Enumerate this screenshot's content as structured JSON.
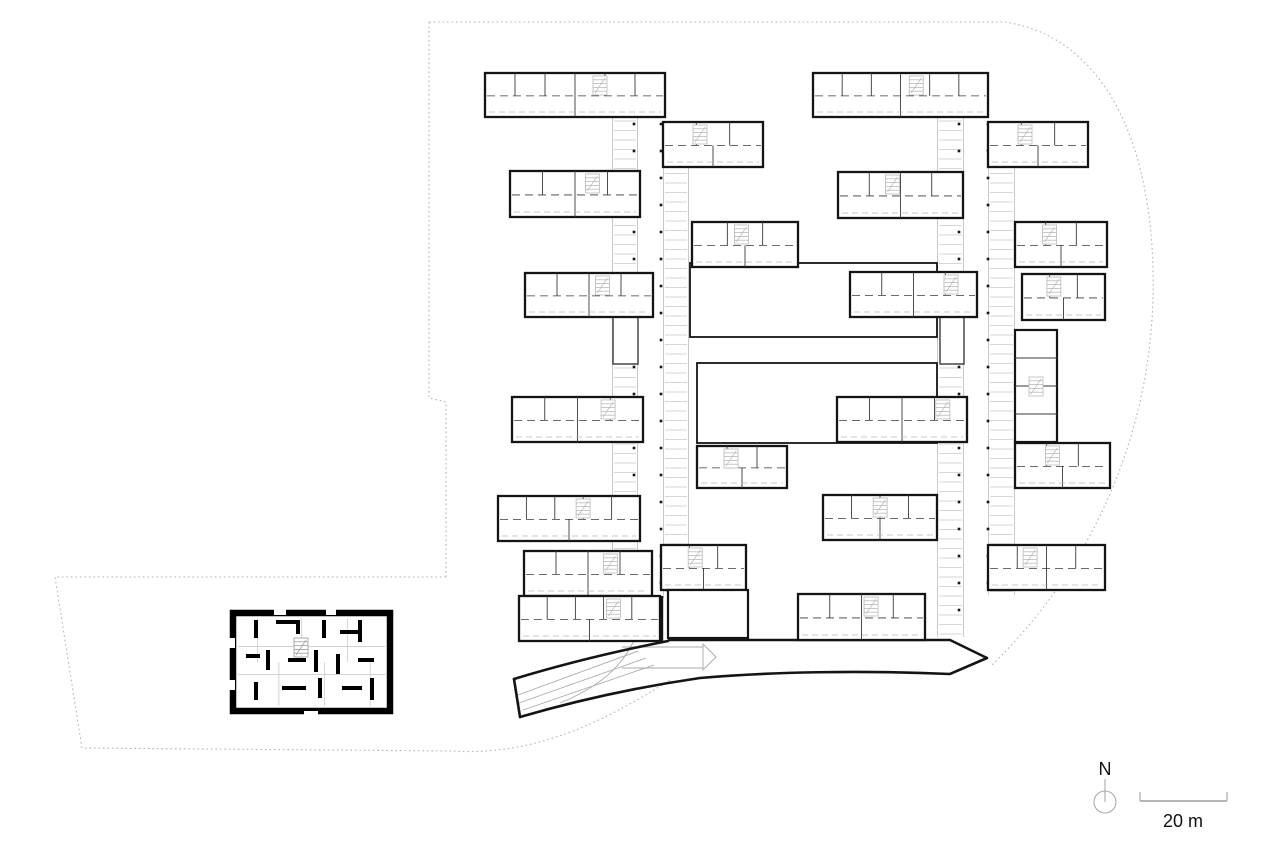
{
  "page": {
    "background": "#ffffff",
    "kind": "architectural floor plan"
  },
  "labels": {
    "north": "N",
    "scale": "20 m"
  },
  "colors": {
    "ink": "#141414",
    "partition": "#3a3a3a",
    "thin": "#a9a9a9",
    "gallery": "#c9c9c9",
    "stair": "#b9b9b9",
    "boundary": "#b3b3b3",
    "scalebar": "#b5b5b5",
    "text": "#111111",
    "paper": "#ffffff"
  },
  "plan": {
    "canvas": {
      "w": 1280,
      "h": 853
    },
    "boundary_paths": [
      "M429,22 H1004 C1092,34 1149,122 1153,268 C1157,418 1100,560 991,666",
      "M429,22 V398 L446,402 V577",
      "M446,577 H55 L82,748 L452,751 C545,757 618,712 672,679"
    ],
    "galleries": [
      {
        "x": 612,
        "y": 117,
        "w": 26,
        "h": 481
      },
      {
        "x": 663,
        "y": 122,
        "w": 26,
        "h": 476
      },
      {
        "x": 937,
        "y": 117,
        "w": 27,
        "h": 520
      },
      {
        "x": 988,
        "y": 122,
        "w": 27,
        "h": 473
      }
    ],
    "dot_columns": [
      {
        "x": 634,
        "y1": 124,
        "y2": 638,
        "step": 27
      },
      {
        "x": 661,
        "y1": 124,
        "y2": 596,
        "step": 27
      },
      {
        "x": 959,
        "y1": 124,
        "y2": 634,
        "step": 27
      },
      {
        "x": 988,
        "y1": 124,
        "y2": 590,
        "step": 27
      }
    ],
    "courts": [
      {
        "x": 690,
        "y": 263,
        "w": 247,
        "h": 74
      },
      {
        "x": 697,
        "y": 363,
        "w": 240,
        "h": 80
      }
    ],
    "connectors": [
      {
        "x": 613,
        "y": 317,
        "w": 25,
        "h": 47
      },
      {
        "x": 940,
        "y": 317,
        "w": 24,
        "h": 47
      }
    ],
    "wings": [
      {
        "x": 485,
        "y": 73,
        "w": 180,
        "h": 44,
        "s": 0.6
      },
      {
        "x": 510,
        "y": 171,
        "w": 130,
        "h": 46,
        "s": 0.58
      },
      {
        "x": 525,
        "y": 273,
        "w": 128,
        "h": 44,
        "s": 0.55
      },
      {
        "x": 512,
        "y": 397,
        "w": 131,
        "h": 45,
        "s": 0.68
      },
      {
        "x": 498,
        "y": 496,
        "w": 142,
        "h": 45,
        "s": 0.55
      },
      {
        "x": 524,
        "y": 551,
        "w": 128,
        "h": 45,
        "s": 0.62
      },
      {
        "x": 519,
        "y": 596,
        "w": 141,
        "h": 45,
        "s": 0.62
      },
      {
        "x": 663,
        "y": 122,
        "w": 100,
        "h": 45,
        "s": 0.3
      },
      {
        "x": 692,
        "y": 222,
        "w": 106,
        "h": 45,
        "s": 0.4
      },
      {
        "x": 838,
        "y": 172,
        "w": 125,
        "h": 46,
        "s": 0.38
      },
      {
        "x": 850,
        "y": 272,
        "w": 127,
        "h": 45,
        "s": 0.74
      },
      {
        "x": 837,
        "y": 397,
        "w": 130,
        "h": 45,
        "s": 0.76
      },
      {
        "x": 697,
        "y": 446,
        "w": 90,
        "h": 42,
        "s": 0.3
      },
      {
        "x": 823,
        "y": 495,
        "w": 114,
        "h": 45,
        "s": 0.44
      },
      {
        "x": 661,
        "y": 545,
        "w": 85,
        "h": 45,
        "s": 0.32
      },
      {
        "x": 813,
        "y": 73,
        "w": 175,
        "h": 44,
        "s": 0.55
      },
      {
        "x": 988,
        "y": 122,
        "w": 100,
        "h": 45,
        "s": 0.3
      },
      {
        "x": 1015,
        "y": 222,
        "w": 92,
        "h": 45,
        "s": 0.3
      },
      {
        "x": 1022,
        "y": 274,
        "w": 83,
        "h": 46,
        "s": 0.3
      },
      {
        "x": 1015,
        "y": 443,
        "w": 95,
        "h": 45,
        "s": 0.32
      },
      {
        "x": 988,
        "y": 545,
        "w": 117,
        "h": 45,
        "s": 0.3
      },
      {
        "x": 798,
        "y": 594,
        "w": 127,
        "h": 46,
        "s": 0.52
      }
    ],
    "blocks": [
      {
        "x": 1015,
        "y": 330,
        "w": 42,
        "h": 112,
        "kind": "stair"
      },
      {
        "x": 668,
        "y": 590,
        "w": 80,
        "h": 48,
        "kind": "empty"
      }
    ],
    "building_edges": [
      "M668,640 H950 L987,658",
      "M649,642 L649,596",
      "M662,596 L662,641"
    ],
    "road": {
      "thick": [
        "M514,679 C560,665 612,652 668,641",
        "M520,717 C585,698 645,686 700,678 C770,672 860,670 950,674 L987,658",
        "M514,679 L520,717"
      ],
      "thin": [
        "M518,695 L638,651",
        "M519,703 L646,658",
        "M523,710 L654,665",
        "M560,703 C612,682 638,652 646,600",
        "M633,638 L648,590 L661,638",
        "M648,590 L649,638",
        "M703,644 L716,657 L703,670 Z",
        "M622,647 L703,647",
        "M622,668 L703,668"
      ]
    },
    "annex": {
      "x": 230,
      "y": 610,
      "w": 163,
      "h": 104
    },
    "north": {
      "cx": 1105,
      "cy": 802,
      "r": 11,
      "stem_top": 779,
      "label_y": 775
    },
    "scalebar": {
      "x1": 1140,
      "x2": 1227,
      "y": 801,
      "tick_h": 9,
      "label_x": 1183,
      "label_y": 827
    }
  }
}
